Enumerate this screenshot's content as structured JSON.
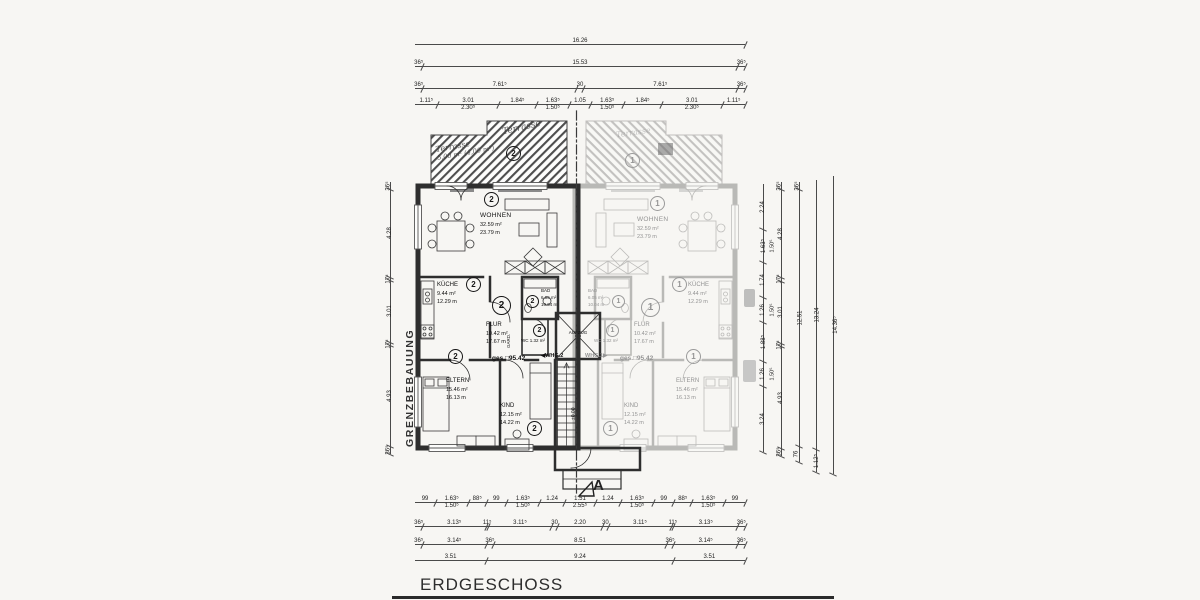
{
  "title": "ERDGESCHOSS",
  "boundary_label": "GRENZBEBAUUNG",
  "section_marker": "A",
  "core": {
    "elevator": "AUFZUG",
    "level": "±0.00"
  },
  "terrace_note": {
    "top": "Terrasse",
    "line1": "Terrasse",
    "line2": "5,00 m² (4,00 m²)"
  },
  "apartment2": {
    "unit": "2",
    "arrow_label": "◀WHG.2",
    "total": "ges.□95.42",
    "rooms": {
      "wohnen": {
        "name": "WOHNEN",
        "area": "32.59 m²",
        "area2": "23.79 m"
      },
      "kueche": {
        "name": "KÜCHE",
        "area": "9.44 m²",
        "area2": "12.29 m"
      },
      "flur": {
        "name": "FLUR",
        "area": "10.42 m²",
        "area2": "17.67 m"
      },
      "bad": {
        "name": "BAD",
        "area": "6.05 m²",
        "area2": "10.04 m"
      },
      "wc": {
        "name": "WC",
        "area": "1.32 m²"
      },
      "gard": {
        "name": "GARD."
      },
      "eltern": {
        "name": "ELTERN",
        "area": "15.46 m²",
        "area2": "16.13 m"
      },
      "kind": {
        "name": "KIND",
        "area": "12.15 m²",
        "area2": "14.22 m"
      }
    }
  },
  "apartment1": {
    "unit": "1",
    "arrow_label": "WHG.1▶",
    "total": "ges.□95.42",
    "rooms": {
      "wohnen": {
        "name": "WOHNEN",
        "area": "32.59 m²",
        "area2": "23.79 m"
      },
      "kueche": {
        "name": "KÜCHE",
        "area": "9.44 m²",
        "area2": "12.29 m"
      },
      "flur": {
        "name": "FLUR",
        "area": "10.42 m²",
        "area2": "17.67 m"
      },
      "bad": {
        "name": "BAD",
        "area": "6.05 m²",
        "area2": "10.04 m"
      },
      "wc": {
        "name": "WC",
        "area": "1.32 m²"
      },
      "gard": {
        "name": "GARD."
      },
      "eltern": {
        "name": "ELTERN",
        "area": "15.46 m²",
        "area2": "16.13 m"
      },
      "kind": {
        "name": "KIND",
        "area": "12.15 m²",
        "area2": "14.22 m"
      }
    }
  },
  "dims": {
    "top1": [
      {
        "v": "16.26",
        "f": 16.26
      }
    ],
    "top2": [
      {
        "v": "36⁵",
        "f": 0.365
      },
      {
        "v": "15.53",
        "f": 15.53
      },
      {
        "v": "36⁵",
        "f": 0.365
      }
    ],
    "top3": [
      {
        "v": "36⁵",
        "f": 0.365
      },
      {
        "v": "7.61⁵",
        "f": 7.615
      },
      {
        "v": "30",
        "f": 0.3
      },
      {
        "v": "7.61⁵",
        "f": 7.615
      },
      {
        "v": "36⁵",
        "f": 0.365
      }
    ],
    "top4": [
      {
        "v": "1.11⁵",
        "f": 1.115
      },
      {
        "v": "3.01",
        "f": 3.01,
        "sub": "2.30⁵"
      },
      {
        "v": "1.84⁵",
        "f": 1.845
      },
      {
        "v": "1.63⁵",
        "f": 1.635,
        "sub": "1.50⁵"
      },
      {
        "v": "1.05",
        "f": 1.05
      },
      {
        "v": "1.63⁵",
        "f": 1.635,
        "sub": "1.50⁵"
      },
      {
        "v": "1.84⁵",
        "f": 1.845
      },
      {
        "v": "3.01",
        "f": 3.01,
        "sub": "2.30⁵"
      },
      {
        "v": "1.11⁵",
        "f": 1.115
      }
    ],
    "left1": [
      {
        "v": "36⁵",
        "f": 0.365
      },
      {
        "v": "4.28",
        "f": 4.28
      },
      {
        "v": "17⁵",
        "f": 0.175
      },
      {
        "v": "3.01",
        "f": 3.01
      },
      {
        "v": "17⁵",
        "f": 0.175
      },
      {
        "v": "4.93",
        "f": 4.93
      },
      {
        "v": "36⁵",
        "f": 0.365
      }
    ],
    "right1": [
      {
        "v": "2.24",
        "f": 2.24
      },
      {
        "v": "1.63⁵",
        "f": 1.635,
        "sub": "1.50⁵"
      },
      {
        "v": "1.74",
        "f": 1.74
      },
      {
        "v": "1.26",
        "f": 1.26,
        "sub": "1.50⁵"
      },
      {
        "v": "1.88⁵",
        "f": 1.885
      },
      {
        "v": "1.26",
        "f": 1.26,
        "sub": "1.50⁵"
      },
      {
        "v": "3.24",
        "f": 3.24
      }
    ],
    "right2": [
      {
        "v": "36⁵",
        "f": 0.365
      },
      {
        "v": "4.28",
        "f": 4.28
      },
      {
        "v": "17⁵",
        "f": 0.175
      },
      {
        "v": "3.01",
        "f": 3.01
      },
      {
        "v": "17⁵",
        "f": 0.175
      },
      {
        "v": "4.93",
        "f": 4.93
      },
      {
        "v": "36⁵",
        "f": 0.365
      }
    ],
    "right3": [
      {
        "v": "36⁵",
        "f": 0.365
      },
      {
        "v": "12.51",
        "f": 12.51
      },
      {
        "v": "76",
        "f": 0.76
      }
    ],
    "right4": [
      {
        "v": "13.24",
        "f": 13.24
      },
      {
        "v": "1.12⁵",
        "f": 1.125
      }
    ],
    "right5": [
      {
        "v": "14.36⁵",
        "f": 14.365
      }
    ],
    "bottom1": [
      {
        "v": "99",
        "f": 0.99
      },
      {
        "v": "1.63⁵",
        "f": 1.635,
        "sub": "1.50⁵"
      },
      {
        "v": "88⁵",
        "f": 0.885
      },
      {
        "v": "99",
        "f": 0.99
      },
      {
        "v": "1.63⁵",
        "f": 1.635,
        "sub": "1.50⁵"
      },
      {
        "v": "1.24",
        "f": 1.24
      },
      {
        "v": "1.51",
        "f": 1.51,
        "sub": "2.55⁵"
      },
      {
        "v": "1.24",
        "f": 1.24
      },
      {
        "v": "1.63⁵",
        "f": 1.635,
        "sub": "1.50⁵"
      },
      {
        "v": "99",
        "f": 0.99
      },
      {
        "v": "88⁵",
        "f": 0.885
      },
      {
        "v": "1.63⁵",
        "f": 1.635,
        "sub": "1.50⁵"
      },
      {
        "v": "99",
        "f": 0.99
      }
    ],
    "bottom2": [
      {
        "v": "36⁵",
        "f": 0.365
      },
      {
        "v": "3.13⁵",
        "f": 3.135
      },
      {
        "v": "11⁵",
        "f": 0.115
      },
      {
        "v": "3.11⁵",
        "f": 3.115
      },
      {
        "v": "30",
        "f": 0.3
      },
      {
        "v": "2.20",
        "f": 2.2
      },
      {
        "v": "30",
        "f": 0.3
      },
      {
        "v": "3.11⁵",
        "f": 3.115
      },
      {
        "v": "11⁵",
        "f": 0.115
      },
      {
        "v": "3.13⁵",
        "f": 3.135
      },
      {
        "v": "36⁵",
        "f": 0.365
      }
    ],
    "bottom3": [
      {
        "v": "36⁵",
        "f": 0.365
      },
      {
        "v": "3.14⁵",
        "f": 3.145
      },
      {
        "v": "36⁵",
        "f": 0.365
      },
      {
        "v": "8.51",
        "f": 8.51
      },
      {
        "v": "36⁵",
        "f": 0.365
      },
      {
        "v": "3.14⁵",
        "f": 3.145
      },
      {
        "v": "36⁵",
        "f": 0.365
      }
    ],
    "bottom4": [
      {
        "v": "3.51",
        "f": 3.51
      },
      {
        "v": "9.24",
        "f": 9.24
      },
      {
        "v": "3.51",
        "f": 3.51
      }
    ]
  }
}
